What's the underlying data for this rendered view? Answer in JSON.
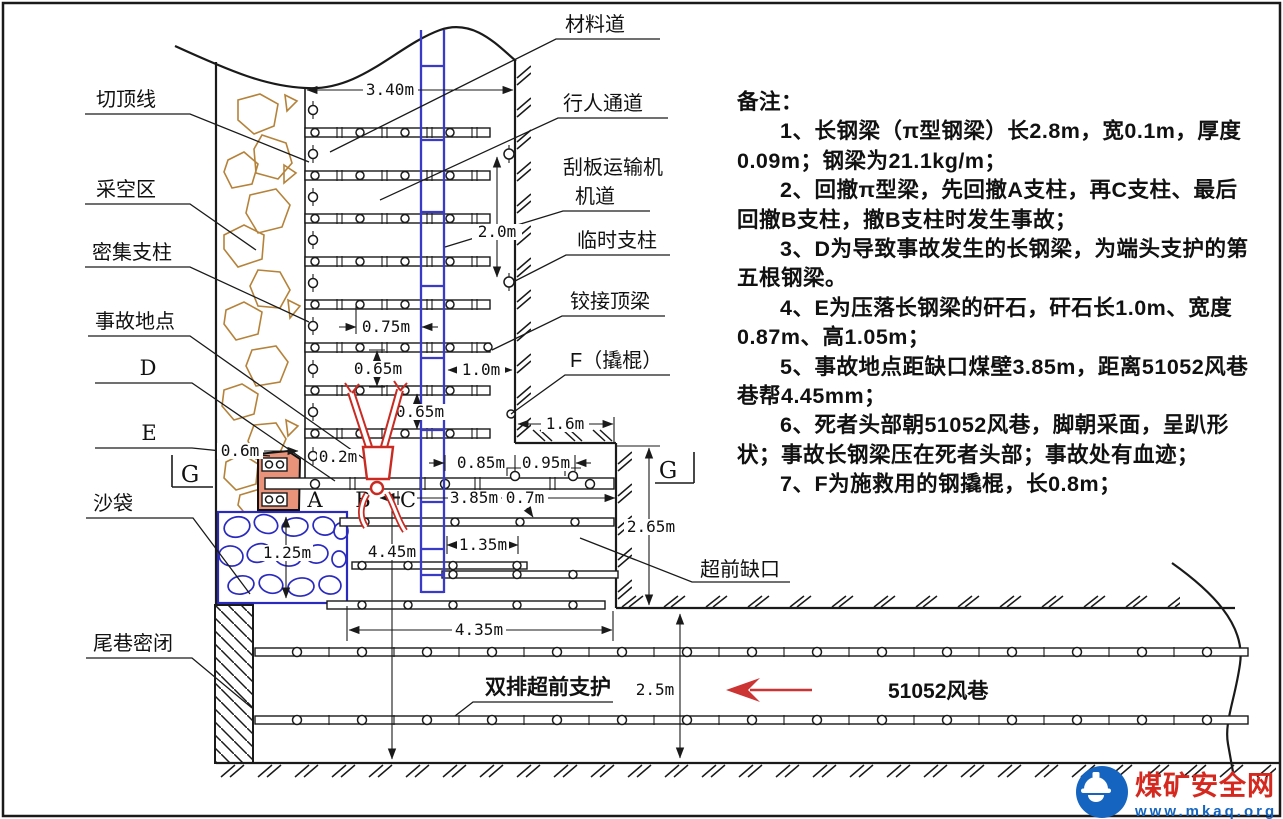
{
  "labels": {
    "qie_ding_xian": "切顶线",
    "cai_kong_qu": "采空区",
    "mi_ji_zhi_zhu": "密集支柱",
    "shi_gu_di_dian": "事故地点",
    "sha_dai": "沙袋",
    "wei_xiang_mi_bi": "尾巷密闭",
    "cai_liao_dao": "材料道",
    "xing_ren_tong_dao": "行人通道",
    "gua_ban_yun_shu_ji": "刮板运输机",
    "ji_dao": "机道",
    "lin_shi_zhi_zhu": "临时支柱",
    "jiao_jie_ding_liang": "铰接顶梁",
    "f_qiao_gun": "F（撬棍）",
    "chao_qian_que_kou": "超前缺口",
    "shuang_pai_chao_qian_zhi_hu": "双排超前支护",
    "fengxiang_51052": "51052风巷"
  },
  "letters": {
    "a": "A",
    "b": "B",
    "c": "C",
    "d": "D",
    "e": "E",
    "g_left": "G",
    "g_right": "G"
  },
  "dimensions": {
    "d3_40": "3.40m",
    "d2_0": "2.0m",
    "d0_75": "0.75m",
    "d0_65_a": "0.65m",
    "d0_65_b": "0.65m",
    "d1_0": "1.0m",
    "d1_6": "1.6m",
    "d0_6": "0.6m",
    "d0_2": "0.2m",
    "d0_85": "0.85m",
    "d0_95": "0.95m",
    "d3_85": "3.85m",
    "d0_7": "0.7m",
    "d4_45": "4.45m",
    "d1_35": "1.35m",
    "d2_65": "2.65m",
    "d1_25": "1.25m",
    "d4_35": "4.35m",
    "d2_5": "2.5m"
  },
  "notes": {
    "title": "备注：",
    "lines": [
      "1、长钢梁（π型钢梁）长2.8m，宽0.1m，厚度",
      "0.09m；钢梁为21.1kg/m；",
      "2、回撤π型梁，先回撤A支柱，再C支柱、最后",
      "回撤B支柱，撤B支柱时发生事故；",
      "3、D为导致事故发生的长钢梁，为端头支护的第",
      "五根钢梁。",
      "4、E为压落长钢梁的矸石，矸石长1.0m、宽度",
      "0.87m、高1.05m；",
      "5、事故地点距缺口煤壁3.85m，距离51052风巷",
      "巷帮4.45mm；",
      "6、死者头部朝51052风巷，脚朝采面，呈趴形",
      "状；事故长钢梁压在死者头部；事故处有血迹；",
      "7、F为施救用的钢撬棍，长0.8m；"
    ]
  },
  "logo": {
    "site_name": "煤矿安全网",
    "site_url": "www.mkaq.org"
  },
  "colors": {
    "line_black": "#1a1a1a",
    "goaf_rock_brown": "#b5823a",
    "sandbag_blue": "#2a2ac0",
    "ladder_blue": "#3a3ac8",
    "rock_e_fill": "#e8937a",
    "figure_red": "#c92a21",
    "arrow_red": "#cc3333",
    "logo_red": "#d5281e",
    "logo_blue": "#1565c0"
  }
}
